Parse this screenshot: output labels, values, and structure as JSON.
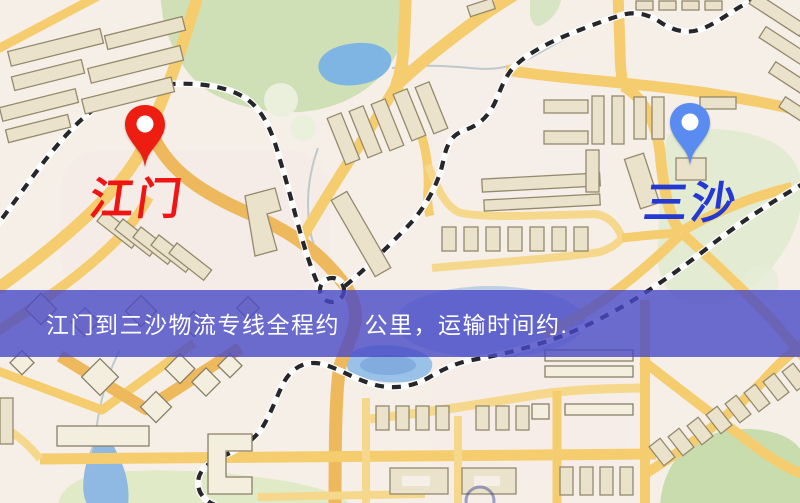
{
  "map": {
    "markers": [
      {
        "name": "jiangmen",
        "label": "江门",
        "pin_color": "#ee1d11",
        "label_color": "#f01414"
      },
      {
        "name": "sansha",
        "label": "三沙",
        "pin_color": "#5a8bf0",
        "label_color": "#2438d4"
      }
    ],
    "banner": {
      "text": "江门到三沙物流专线全程约　公里，运输时间约.",
      "background": "#4949c6",
      "text_color": "#ffffff"
    },
    "palette": {
      "land": "#f6efe8",
      "road_yellow": "#f5cd6e",
      "road_orange": "#eeb95c",
      "building": "#eae2ca",
      "building_outline": "#95896c",
      "green_area": "#cfe0b6",
      "water": "#7fb5e3",
      "railway_dark": "#26262b",
      "railway_light": "#fdfdfd"
    }
  }
}
